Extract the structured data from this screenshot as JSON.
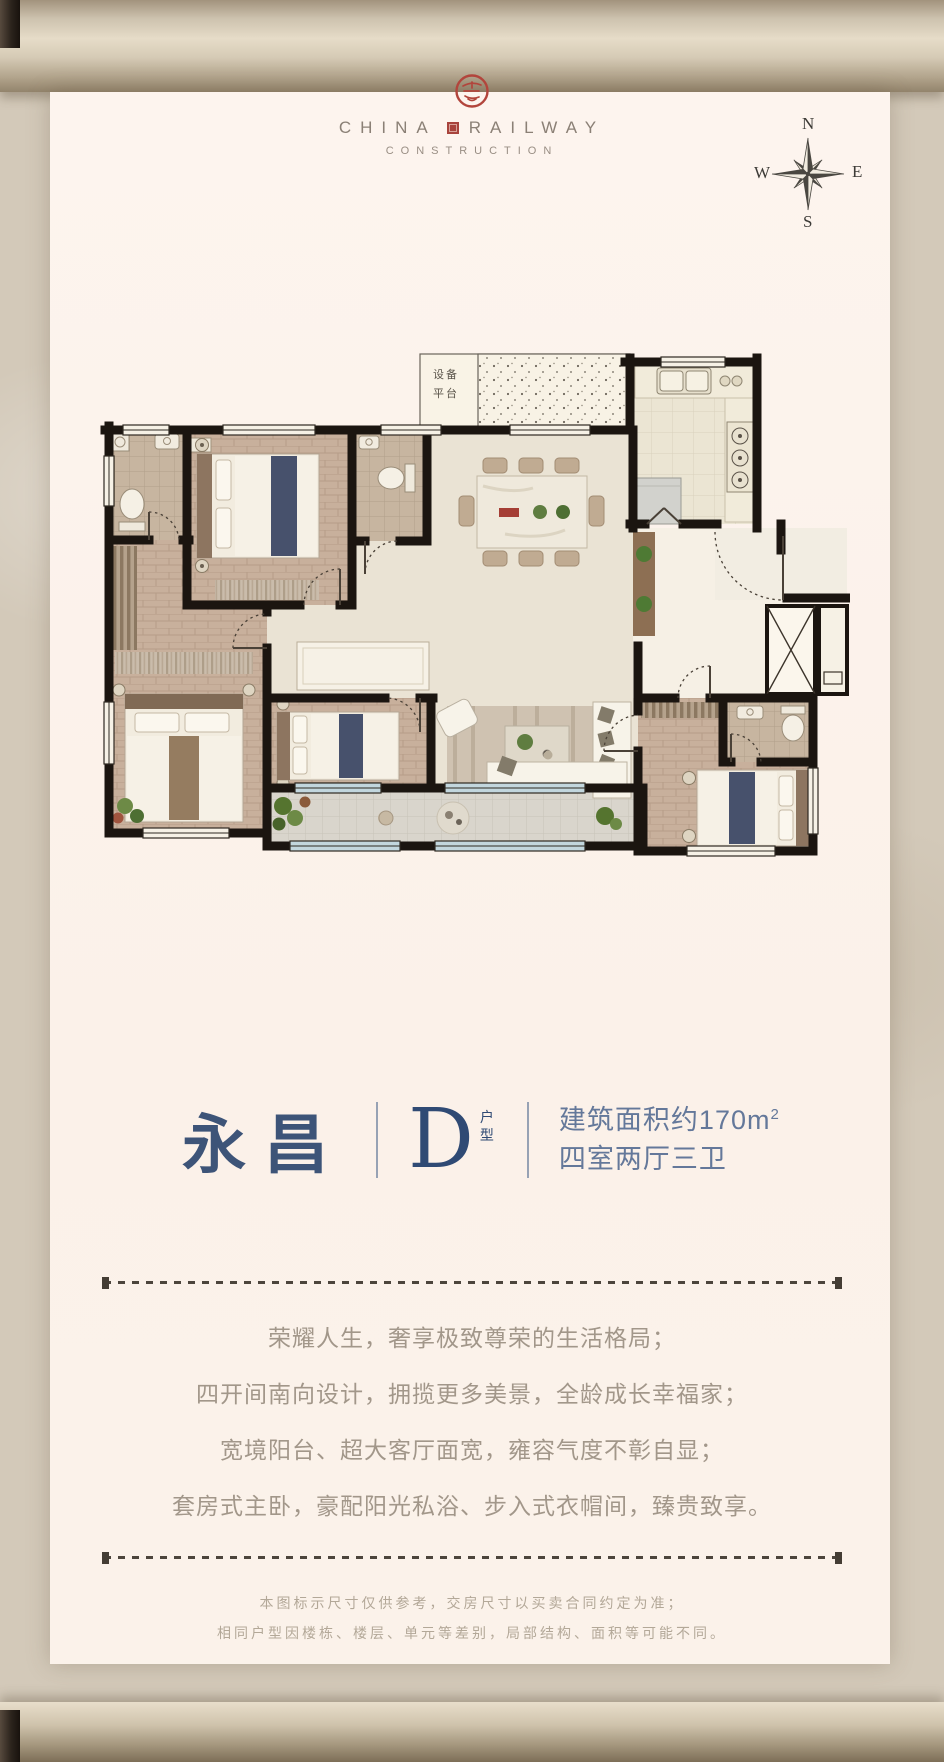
{
  "brand": {
    "line1_left": "CHINA",
    "line1_right": "RAILWAY",
    "line2": "CONSTRUCTION"
  },
  "compass": {
    "n": "N",
    "e": "E",
    "s": "S",
    "w": "W"
  },
  "plan": {
    "platform_label": "设备平台"
  },
  "unit": {
    "name": "永昌",
    "type_letter": "D",
    "type_label": "户型",
    "area_main": "建筑面积约170m",
    "area_sup": "2",
    "rooms": "四室两厅三卫"
  },
  "description": {
    "line1": "荣耀人生，奢享极致尊荣的生活格局；",
    "line2": "四开间南向设计，拥揽更多美景，全龄成长幸福家；",
    "line3": "宽境阳台、超大客厅面宽，雍容气度不彰自显；",
    "line4": "套房式主卧，豪配阳光私浴、步入式衣帽间，臻贵致享。"
  },
  "disclaimer": {
    "line1": "本图标示尺寸仅供参考，交房尺寸以买卖合同约定为准；",
    "line2": "相同户型因楼栋、楼层、单元等差别，局部结构、面积等可能不同。"
  },
  "colors": {
    "seal_red": "#b2453c",
    "title_navy": "#3d5478",
    "info_blue": "#64789a",
    "wall_black": "#1b1510",
    "parchment": "#d3c9b9",
    "card_cream": "#fcf3ec"
  }
}
